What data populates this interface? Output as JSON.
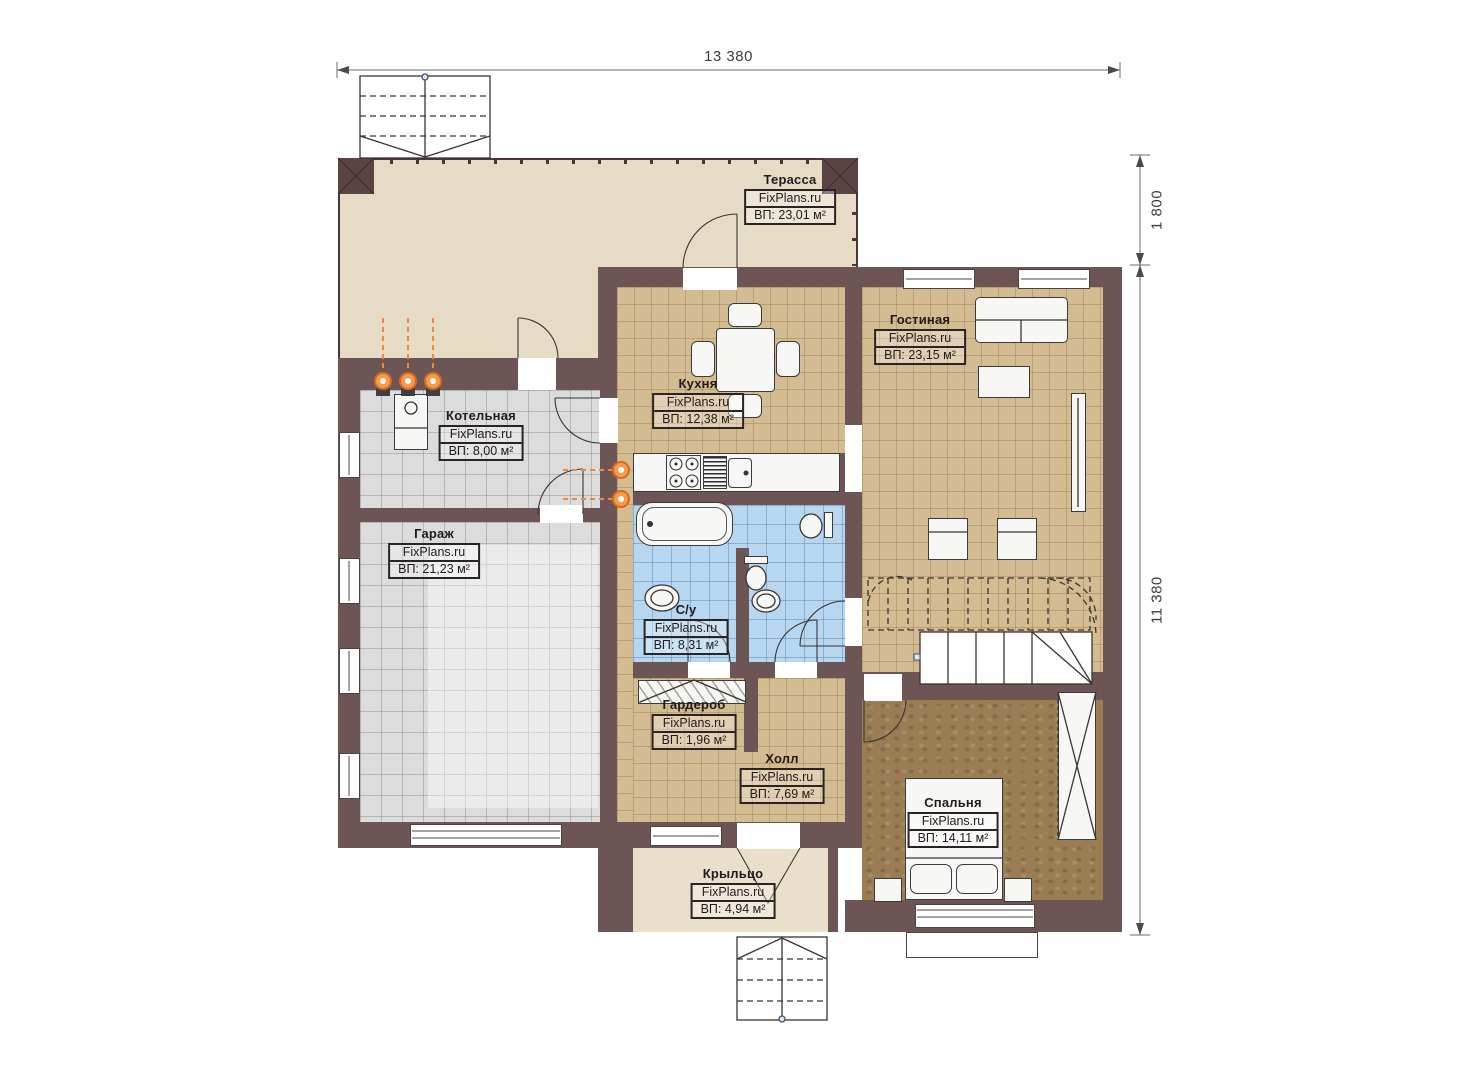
{
  "plan_title": "Floor plan, 1st floor",
  "brand": "FixPlans.ru",
  "dimensions": {
    "width_top": "13 380",
    "terrace_depth": "1 800",
    "height_right": "11 380"
  },
  "rooms": {
    "terrace": {
      "name": "Терасса",
      "brand": "FixPlans.ru",
      "area": "ВП: 23,01 м²"
    },
    "boiler": {
      "name": "Котельная",
      "brand": "FixPlans.ru",
      "area": "ВП: 8,00 м²"
    },
    "garage": {
      "name": "Гараж",
      "brand": "FixPlans.ru",
      "area": "ВП: 21,23 м²"
    },
    "kitchen": {
      "name": "Кухня",
      "brand": "FixPlans.ru",
      "area": "ВП: 12,38 м²"
    },
    "living": {
      "name": "Гостиная",
      "brand": "FixPlans.ru",
      "area": "ВП: 23,15 м²"
    },
    "bathroom": {
      "name": "С/у",
      "brand": "FixPlans.ru",
      "area": "ВП: 8,31 м²"
    },
    "wardrobe": {
      "name": "Гардероб",
      "brand": "FixPlans.ru",
      "area": "ВП: 1,96 м²"
    },
    "hall": {
      "name": "Холл",
      "brand": "FixPlans.ru",
      "area": "ВП: 7,69 м²"
    },
    "bedroom": {
      "name": "Спальня",
      "brand": "FixPlans.ru",
      "area": "ВП: 14,11 м²"
    },
    "porch": {
      "name": "Крыльцо",
      "brand": "FixPlans.ru",
      "area": "ВП: 4,94 м²"
    }
  },
  "colors": {
    "wall": "#6d5555",
    "terrace_floor": "#e6dcc6",
    "tile_tan": "#d4bc92",
    "tile_gray": "#dcdcdc",
    "tile_blue": "#b7d7f0",
    "carpet_brown": "#9a7d53",
    "porch_floor": "#ead9ca",
    "heating_orange": "#ef8a3d"
  }
}
